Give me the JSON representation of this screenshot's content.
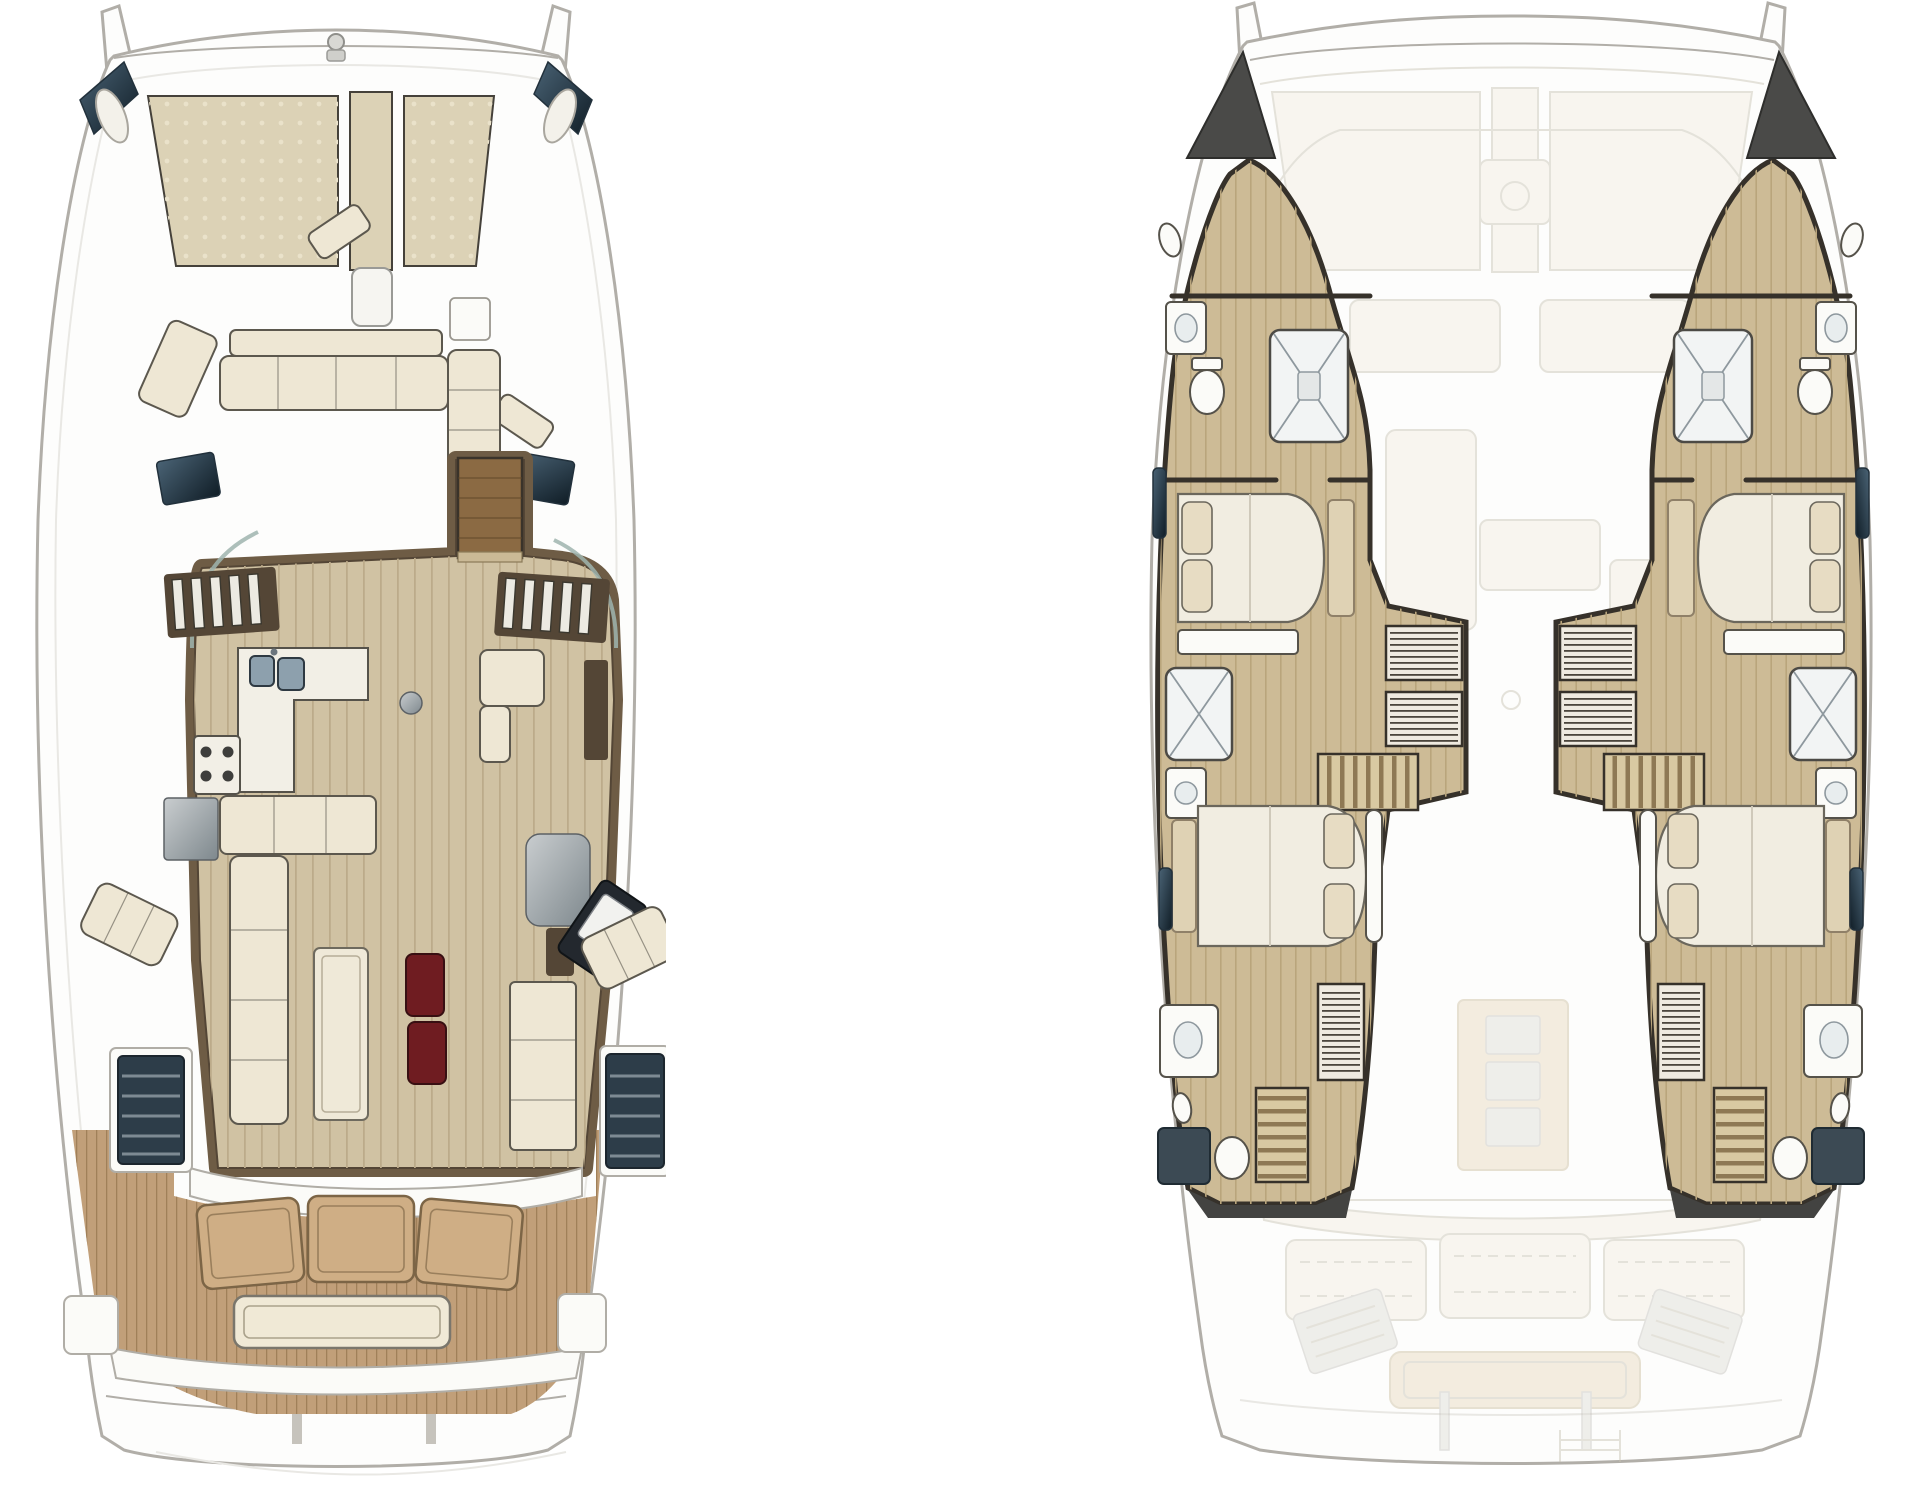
{
  "page": {
    "title": "Catamaran layout drawings - two deck plans side by side",
    "background": "#ffffff",
    "panels": [
      {
        "title": "Main deck plan",
        "position": "left",
        "areas": [
          "twin bows with forestay fittings and bow seat pads",
          "trampoline nets (2 dotted panels) with centre walkway",
          "anchor fitting on forward crossbeam",
          "angled dark bow windows (2)",
          "foredeck lounge: settee with backrest, angled corner seats, chaise pad, side table",
          "salon with walnut walls and plank floor",
          "curved tinted glass front corners",
          "side window slat rows (port and starboard)",
          "companionway door in wood",
          "galley: L-counter with double sink, 4-burner stove, fridge module",
          "L-shaped settee with long saloon table",
          "burgundy ottomans (2)",
          "round side table",
          "starboard lounge armchair and tall cabinet",
          "navigator seat with pedestal and angled helm console",
          "aft cabinet unit",
          "hull access stair wells (dark, 2)",
          "angled sun pads on side decks (2)",
          "aft cockpit: curved bulkhead, 3-section teak lounge, teak floor",
          "transom bench",
          "swim platform with posts and stern steps"
        ]
      },
      {
        "title": "Accommodation deck plan",
        "position": "right",
        "hulls": [
          {
            "name": "port hull",
            "fixtures": [
              "dark bow stowage wedge",
              "forward bathroom: wash unit, toilet, shower cubicle with X glass",
              "porthole ovals (2)",
              "forward double berth with 2 pillows and foot shelf",
              "hanging wardrobes with rail stripes (2)",
              "mid shower room and basin",
              "athwartship steps",
              "aft double berth with 2 pillows and curved headboard",
              "tall striped wardrobe",
              "aft bathroom: basin console, toilet, dark shower pan",
              "aft staircase",
              "dark transom cap",
              "outboard hull windows (3)"
            ]
          },
          {
            "name": "starboard hull",
            "fixtures": [
              "mirrored copy of port hull arrangement: bow wedge, forward bathroom, double berths fore and aft, wardrobes, showers, steps and transom cap"
            ]
          }
        ],
        "ghosted_overlay": [
          "hull silhouette and crossbeams",
          "trampoline panels and walkway",
          "anchor locker with windlass",
          "coachroof outline",
          "foredeck cushions",
          "galley bar and island",
          "saloon settee and armchair",
          "mast foot ring",
          "low table with 3 drawers",
          "cockpit 3-section lounge (dashed stitching)",
          "transom bench",
          "angled engine hatches (2)",
          "davit posts and swim ladder"
        ]
      }
    ]
  },
  "counts": {
    "double_berths": 4,
    "shower_cubicles_visible": 6,
    "trampoline_panels": 2,
    "ottomans": 2,
    "cockpit_lounge_sections": 3
  },
  "colors": {
    "hull_line": "#b1aea8",
    "deck_white": "#fdfdfc",
    "shadow": "#e9e8e4",
    "tramp": "#dcd2b6",
    "tramp_dot": "#eae2ca",
    "tramp_line": "#45413a",
    "navy_hi": "#4a6375",
    "navy_lo": "#101d26",
    "cushion": "#eee7d4",
    "cushion_line": "#5c584e",
    "walnut": "#6e5c45",
    "walnut_deep": "#544636",
    "floor": "#d0c2a3",
    "plank": "#bcab8a",
    "door_wood": "#8b6a43",
    "counter": "#f2efe6",
    "sink": "#8da0ad",
    "pouf": "#6f1c21",
    "steel_hi": "#c9cdcf",
    "steel_lo": "#7e888d",
    "teak": "#c19f79",
    "teak_line": "#a08059",
    "teak_panel": "#cfae85",
    "teak_panel_line": "#7c6546",
    "stair_navy": "#2d3d49",
    "tread_light": "#8b98a1",
    "cabin_floor": "#cdbb96",
    "cabin_plank": "#b9a57c",
    "wall": "#36312a",
    "bed": "#f1ede1",
    "bed_line": "#6b675c",
    "pillow": "#e7dcc3",
    "stripe_bg": "#efeae0",
    "stripe": "#4b453c",
    "step_tan": "#d8c9a2",
    "step_line": "#8e7954",
    "fixture": "#fbfbf8",
    "fixture_line": "#55524a",
    "glass": "#9fb4ae",
    "dark_cap": "#434341",
    "ghost_fill": "#f2ede1",
    "ghost_line": "#c8c2b2",
    "ghost_tan": "#e7d9bc",
    "ghost_gray": "#dddcd6"
  }
}
